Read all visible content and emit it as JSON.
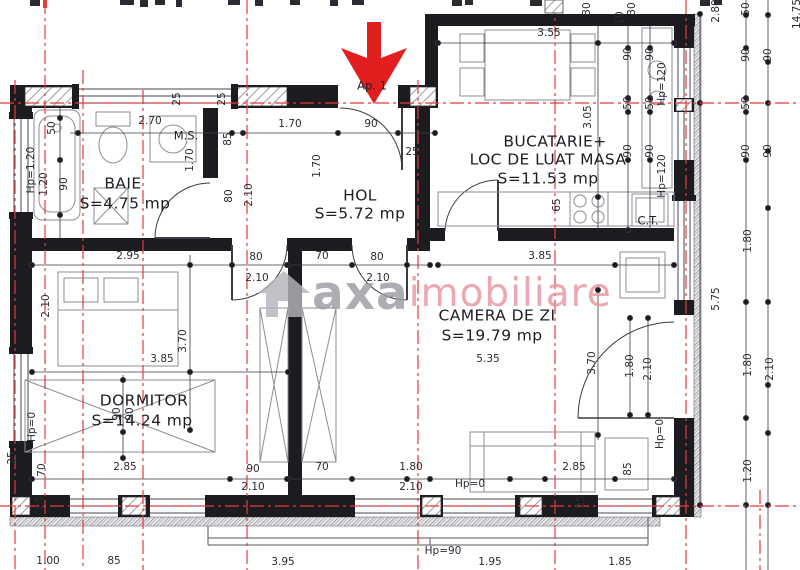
{
  "plan": {
    "unit_label": "Ap. 1",
    "watermark": {
      "icon": "house-icon",
      "brand": "axa",
      "suffix": "imobiliare",
      "brand_color": "#9c9ca4",
      "suffix_color": "#e8959e"
    },
    "colors": {
      "wall": "#1c1c20",
      "dimension": "#2b2b33",
      "axis": "#e23b3b",
      "arrow": "#e31e1e",
      "furniture": "#8d8d96",
      "hatch": "#9a9aa0"
    },
    "rooms": [
      {
        "name": "BAIE",
        "area": "S=4.75 mp"
      },
      {
        "name": "HOL",
        "area": "S=5.72 mp"
      },
      {
        "name": "BUCATARIE+ LOC DE LUAT MASA",
        "area": "S=11.53 mp"
      },
      {
        "name": "CAMERA DE ZI",
        "area": "S=19.79 mp"
      },
      {
        "name": "DORMITOR",
        "area": "S=14.24 mp"
      }
    ],
    "texts": [
      {
        "t": "BAIE",
        "x": 123,
        "y": 184,
        "k": "room"
      },
      {
        "t": "S=4.75 mp",
        "x": 125,
        "y": 204,
        "k": "room"
      },
      {
        "t": "HOL",
        "x": 360,
        "y": 196,
        "k": "room"
      },
      {
        "t": "S=5.72 mp",
        "x": 360,
        "y": 214,
        "k": "room"
      },
      {
        "t": "BUCATARIE+",
        "x": 555,
        "y": 142,
        "k": "room"
      },
      {
        "t": "LOC DE LUAT MASA",
        "x": 548,
        "y": 160,
        "k": "room"
      },
      {
        "t": "S=11.53 mp",
        "x": 548,
        "y": 179,
        "k": "room"
      },
      {
        "t": "CAMERA DE ZI",
        "x": 497,
        "y": 316,
        "k": "room"
      },
      {
        "t": "S=19.79 mp",
        "x": 492,
        "y": 336,
        "k": "room"
      },
      {
        "t": "DORMITOR",
        "x": 144,
        "y": 401,
        "k": "room"
      },
      {
        "t": "S=14.24 mp",
        "x": 142,
        "y": 421,
        "k": "room"
      },
      {
        "t": "M.S.",
        "x": 186,
        "y": 136,
        "k": "small"
      },
      {
        "t": "C.T.",
        "x": 648,
        "y": 221,
        "k": "small"
      },
      {
        "t": "Ap. 1",
        "x": 372,
        "y": 86,
        "k": "small"
      },
      {
        "t": "2.70",
        "x": 150,
        "y": 121,
        "k": "dim"
      },
      {
        "t": "1.70",
        "x": 290,
        "y": 124,
        "k": "dim"
      },
      {
        "t": "90",
        "x": 371,
        "y": 124,
        "k": "dim"
      },
      {
        "t": "3.55",
        "x": 549,
        "y": 33,
        "k": "dim"
      },
      {
        "t": "25",
        "x": 412,
        "y": 152,
        "k": "dim"
      },
      {
        "t": "2.95",
        "x": 128,
        "y": 256,
        "k": "dim"
      },
      {
        "t": "80",
        "x": 256,
        "y": 257,
        "k": "dim"
      },
      {
        "t": "2.10",
        "x": 257,
        "y": 278,
        "k": "dim"
      },
      {
        "t": "70",
        "x": 322,
        "y": 256,
        "k": "dim"
      },
      {
        "t": "80",
        "x": 377,
        "y": 257,
        "k": "dim"
      },
      {
        "t": "2.10",
        "x": 378,
        "y": 278,
        "k": "dim"
      },
      {
        "t": "3.85",
        "x": 540,
        "y": 256,
        "k": "dim"
      },
      {
        "t": "3.85",
        "x": 162,
        "y": 359,
        "k": "dim"
      },
      {
        "t": "5.35",
        "x": 488,
        "y": 359,
        "k": "dim"
      },
      {
        "t": "2.85",
        "x": 125,
        "y": 467,
        "k": "dim"
      },
      {
        "t": "90",
        "x": 253,
        "y": 469,
        "k": "dim"
      },
      {
        "t": "2.10",
        "x": 253,
        "y": 487,
        "k": "dim"
      },
      {
        "t": "70",
        "x": 322,
        "y": 467,
        "k": "dim"
      },
      {
        "t": "1.80",
        "x": 411,
        "y": 467,
        "k": "dim"
      },
      {
        "t": "2.10",
        "x": 411,
        "y": 487,
        "k": "dim"
      },
      {
        "t": "Hp=0",
        "x": 470,
        "y": 484,
        "k": "dim"
      },
      {
        "t": "2.85",
        "x": 574,
        "y": 467,
        "k": "dim"
      },
      {
        "t": "1.00",
        "x": 48,
        "y": 561,
        "k": "dim"
      },
      {
        "t": "85",
        "x": 114,
        "y": 561,
        "k": "dim"
      },
      {
        "t": "3.95",
        "x": 283,
        "y": 562,
        "k": "dim"
      },
      {
        "t": "Hp=90",
        "x": 443,
        "y": 551,
        "k": "dim"
      },
      {
        "t": "1.95",
        "x": 490,
        "y": 562,
        "k": "dim"
      },
      {
        "t": "1.85",
        "x": 620,
        "y": 562,
        "k": "dim"
      },
      {
        "t": "25",
        "x": 177,
        "y": 99,
        "k": "dimv"
      },
      {
        "t": "25",
        "x": 222,
        "y": 99,
        "k": "dimv"
      },
      {
        "t": "85",
        "x": 228,
        "y": 139,
        "k": "dimv"
      },
      {
        "t": "1.70",
        "x": 190,
        "y": 160,
        "k": "dimv"
      },
      {
        "t": "80",
        "x": 229,
        "y": 196,
        "k": "dimv"
      },
      {
        "t": "2.10",
        "x": 249,
        "y": 195,
        "k": "dimv"
      },
      {
        "t": "1.70",
        "x": 317,
        "y": 166,
        "k": "dimv"
      },
      {
        "t": "50",
        "x": 52,
        "y": 128,
        "k": "dimv"
      },
      {
        "t": "Hp=1.20",
        "x": 31,
        "y": 170,
        "k": "dimv"
      },
      {
        "t": "1.20",
        "x": 44,
        "y": 184,
        "k": "dimv"
      },
      {
        "t": "90",
        "x": 64,
        "y": 184,
        "k": "dimv"
      },
      {
        "t": "2.10",
        "x": 46,
        "y": 306,
        "k": "dimv"
      },
      {
        "t": "Hp=0",
        "x": 32,
        "y": 427,
        "k": "dimv"
      },
      {
        "t": "90",
        "x": 117,
        "y": 414,
        "k": "dimv"
      },
      {
        "t": "90",
        "x": 130,
        "y": 414,
        "k": "dimv"
      },
      {
        "t": "70",
        "x": 42,
        "y": 470,
        "k": "dimv"
      },
      {
        "t": "25",
        "x": 12,
        "y": 458,
        "k": "dimv"
      },
      {
        "t": "25",
        "x": 40,
        "y": 503,
        "k": "dimv"
      },
      {
        "t": "3.70",
        "x": 183,
        "y": 341,
        "k": "dimv"
      },
      {
        "t": "3.70",
        "x": 592,
        "y": 363,
        "k": "dimv"
      },
      {
        "t": "1.80",
        "x": 630,
        "y": 366,
        "k": "dimv"
      },
      {
        "t": "2.10",
        "x": 648,
        "y": 369,
        "k": "dimv"
      },
      {
        "t": "30",
        "x": 587,
        "y": 9,
        "k": "dimv"
      },
      {
        "t": "10",
        "x": 620,
        "y": 18,
        "k": "dimv"
      },
      {
        "t": "30",
        "x": 632,
        "y": 9,
        "k": "dimv"
      },
      {
        "t": "90",
        "x": 628,
        "y": 54,
        "k": "dimv"
      },
      {
        "t": "90",
        "x": 650,
        "y": 54,
        "k": "dimv"
      },
      {
        "t": "50",
        "x": 628,
        "y": 103,
        "k": "dimv"
      },
      {
        "t": "50",
        "x": 650,
        "y": 103,
        "k": "dimv"
      },
      {
        "t": "90",
        "x": 628,
        "y": 151,
        "k": "dimv"
      },
      {
        "t": "90",
        "x": 650,
        "y": 151,
        "k": "dimv"
      },
      {
        "t": "3.05",
        "x": 588,
        "y": 117,
        "k": "dimv"
      },
      {
        "t": "Hp=120",
        "x": 662,
        "y": 84,
        "k": "dimv"
      },
      {
        "t": "Hp=120",
        "x": 662,
        "y": 176,
        "k": "dimv"
      },
      {
        "t": "65",
        "x": 557,
        "y": 205,
        "k": "dimv"
      },
      {
        "t": "85",
        "x": 628,
        "y": 469,
        "k": "dimv"
      },
      {
        "t": "Hp=0",
        "x": 660,
        "y": 434,
        "k": "dimv"
      },
      {
        "t": "25",
        "x": 581,
        "y": 502,
        "k": "dimv"
      },
      {
        "t": "5.75",
        "x": 716,
        "y": 299,
        "k": "dimv"
      },
      {
        "t": "2.80",
        "x": 716,
        "y": 11,
        "k": "dimv"
      },
      {
        "t": "50",
        "x": 746,
        "y": 9,
        "k": "dimv"
      },
      {
        "t": "90",
        "x": 746,
        "y": 55,
        "k": "dimv"
      },
      {
        "t": "90",
        "x": 768,
        "y": 55,
        "k": "dimv"
      },
      {
        "t": "50",
        "x": 746,
        "y": 103,
        "k": "dimv"
      },
      {
        "t": "90",
        "x": 746,
        "y": 151,
        "k": "dimv"
      },
      {
        "t": "90",
        "x": 768,
        "y": 151,
        "k": "dimv"
      },
      {
        "t": "1.80",
        "x": 748,
        "y": 241,
        "k": "dimv"
      },
      {
        "t": "1.80",
        "x": 748,
        "y": 365,
        "k": "dimv"
      },
      {
        "t": "2.10",
        "x": 770,
        "y": 369,
        "k": "dimv"
      },
      {
        "t": "1.20",
        "x": 748,
        "y": 471,
        "k": "dimv"
      },
      {
        "t": "14.75",
        "x": 797,
        "y": 14,
        "k": "dimv"
      }
    ]
  }
}
